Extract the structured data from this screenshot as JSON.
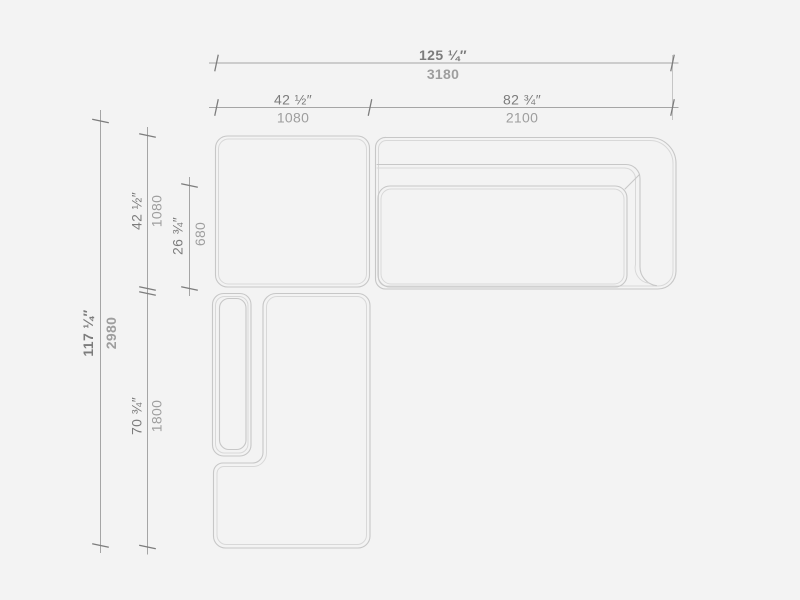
{
  "canvas": {
    "background": "#f3f3f3",
    "furniture_line_color": "#c7c7c7",
    "furniture_inner_line_color": "#d8d8d8",
    "dimension_line_color": "#a5a5a5",
    "tick_color": "#7c7c7c",
    "inches_text_color": "#7c7c7c",
    "mm_text_color": "#9e9e9e"
  },
  "dimensions": {
    "overall_width": {
      "inches": "125 ¼″",
      "mm": "3180"
    },
    "corner_width": {
      "inches": "42 ½″",
      "mm": "1080"
    },
    "sofa_width": {
      "inches": "82 ¾″",
      "mm": "2100"
    },
    "overall_depth": {
      "inches": "117 ¼″",
      "mm": "2980"
    },
    "corner_depth": {
      "inches": "42 ½″",
      "mm": "1080"
    },
    "cushion_depth": {
      "inches": "26 ¾″",
      "mm": "680"
    },
    "chaise_depth": {
      "inches": "70 ¾″",
      "mm": "1800"
    }
  }
}
